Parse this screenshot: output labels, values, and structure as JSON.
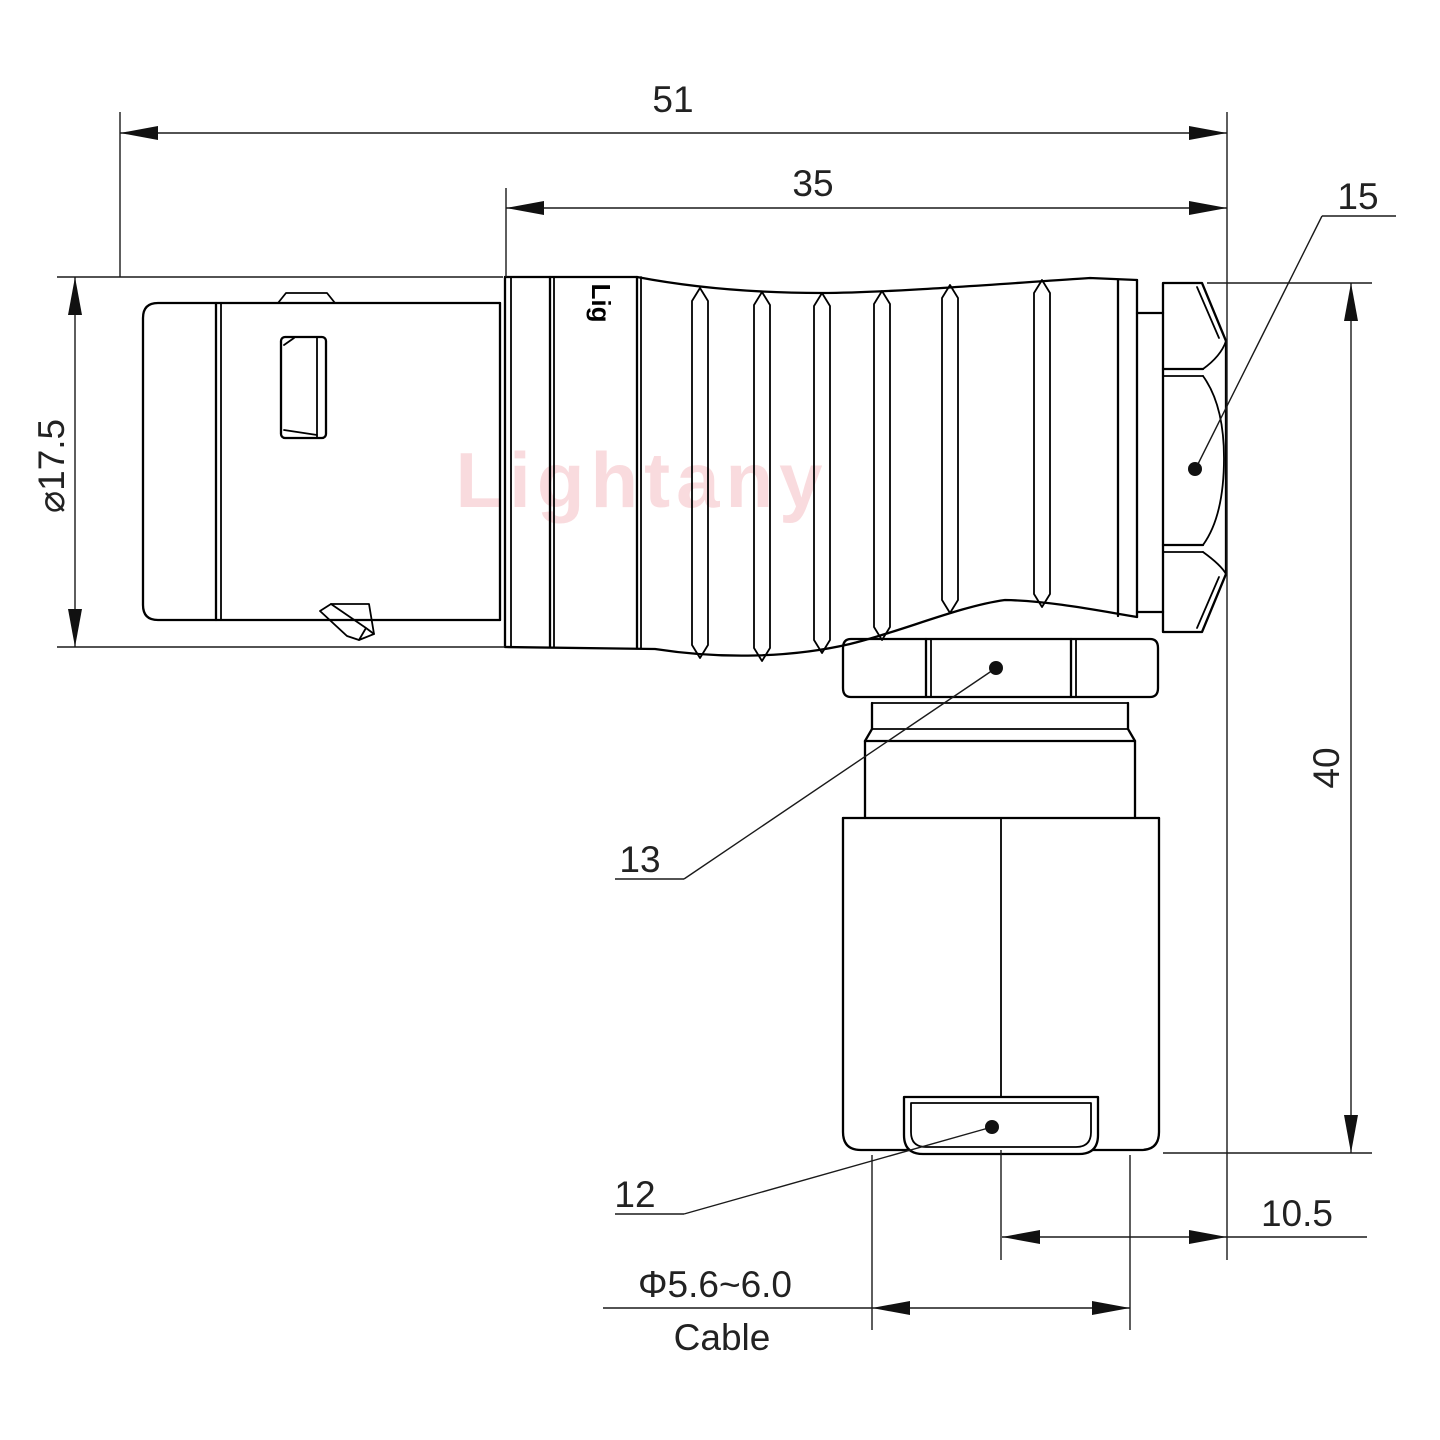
{
  "watermark": "Lightany",
  "brand_mark": "Lig",
  "dims": {
    "overall_length": "51",
    "body_length": "35",
    "nut_ref": "15",
    "shell_dia": "⌀17.5",
    "height": "40",
    "coupling_ref": "13",
    "bushing_ref": "12",
    "offset": "10.5",
    "cable_dia": "Φ5.6~6.0",
    "cable_label": "Cable"
  },
  "colors": {
    "line": "#000000",
    "watermark_pink": "#f5bfc4",
    "background": "#ffffff"
  }
}
